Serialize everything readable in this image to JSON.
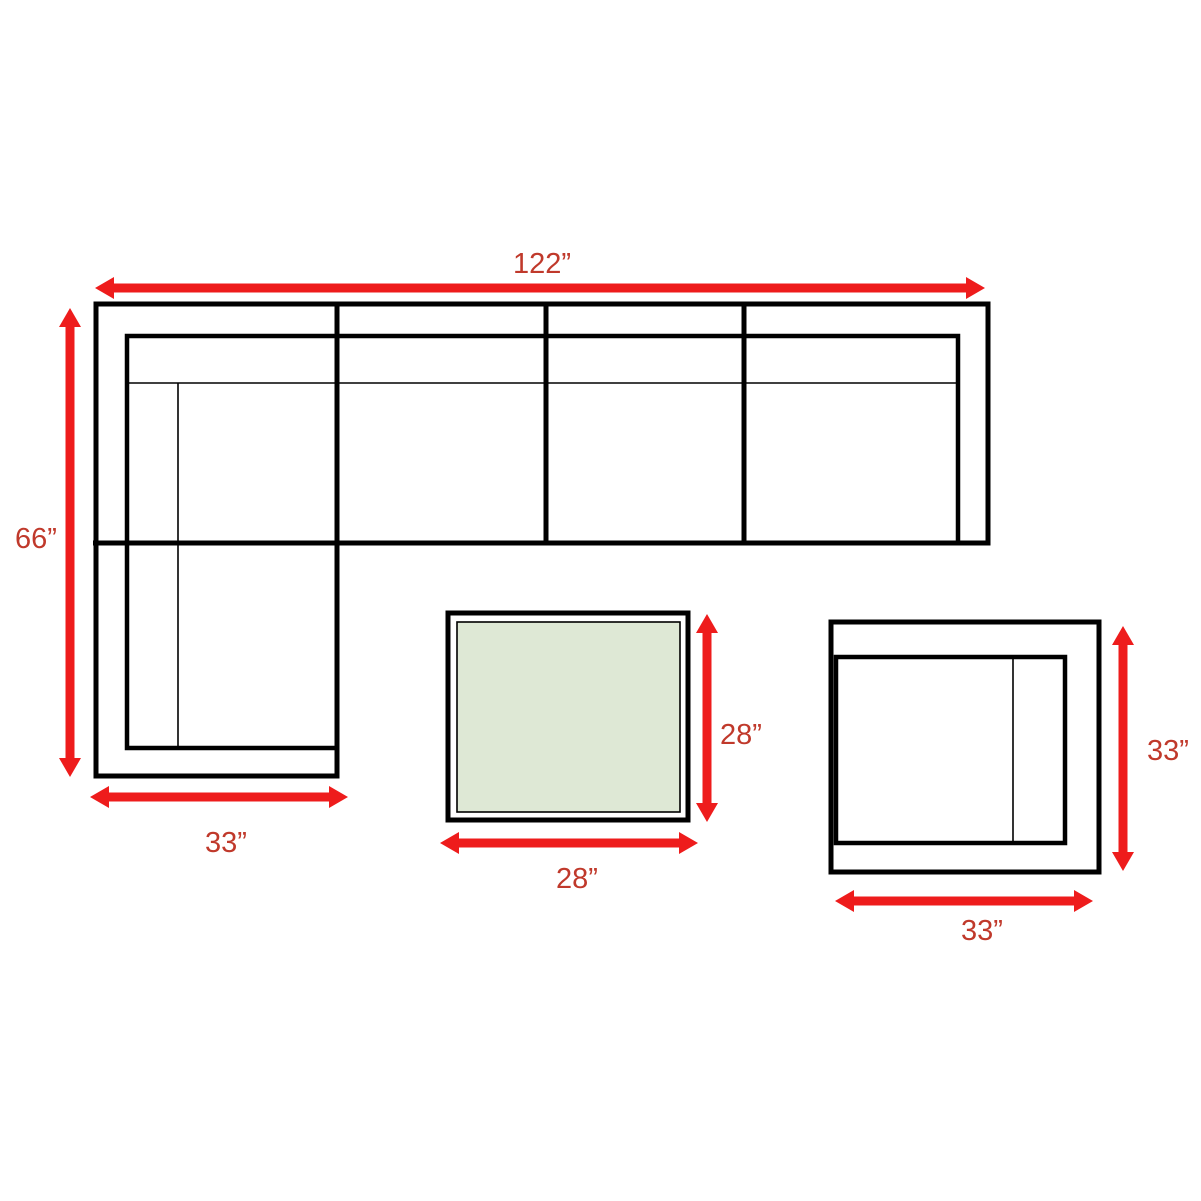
{
  "diagram": {
    "colors": {
      "arrow_red": "#ee1c1c",
      "dimension_text_red": "#c0392b",
      "table_top_green": "#dee8d5",
      "outline_black": "#000000",
      "background": "#ffffff"
    },
    "labels": {
      "sofa_width": "122”",
      "sofa_depth": "66”",
      "chaise_width": "33”",
      "coffee_table_depth": "28”",
      "coffee_table_width": "28”",
      "side_table_depth": "33”",
      "side_table_width": "33”"
    },
    "items": [
      {
        "name": "sectional-sofa",
        "width": "122”",
        "depth": "66”",
        "chaise_width": "33”"
      },
      {
        "name": "coffee-table",
        "width": "28”",
        "depth": "28”"
      },
      {
        "name": "side-table",
        "width": "33”",
        "depth": "33”"
      }
    ]
  }
}
